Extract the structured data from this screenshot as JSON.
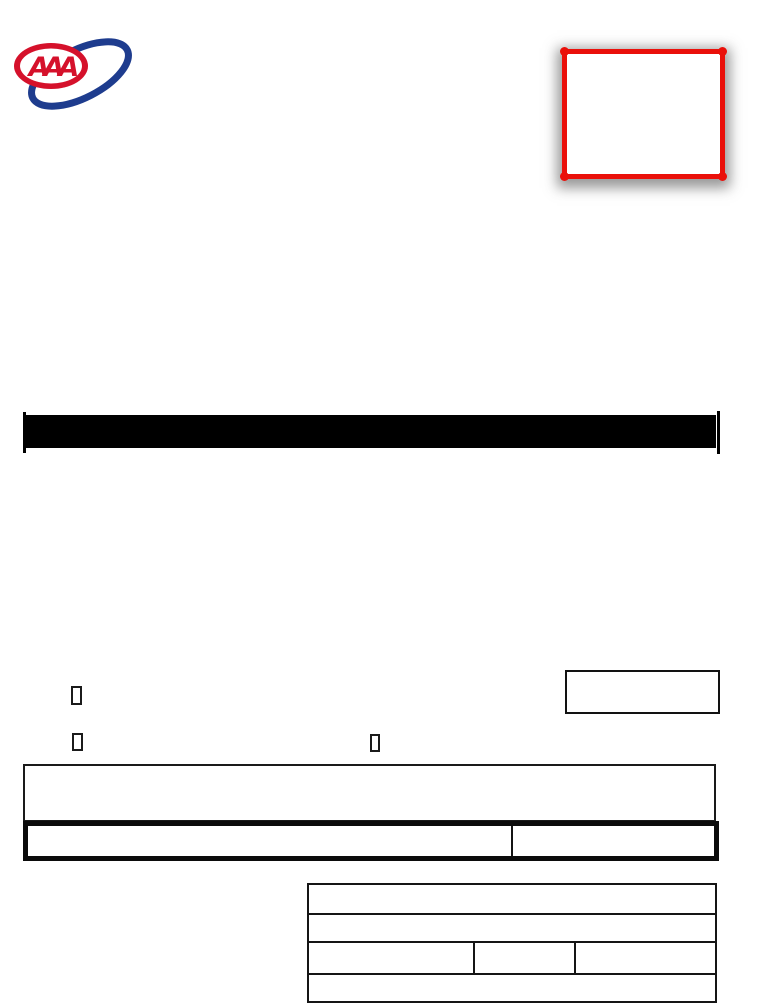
{
  "logo": {
    "label": "AAA",
    "oval_color": "#d5112b",
    "letter_color": "#d5112b",
    "swoosh_color": "#1e3c8e"
  },
  "stamp_box": {
    "border_color": "#ea100a",
    "value": ""
  },
  "divider_bar": {
    "color": "#000000"
  },
  "checkboxes": [
    {
      "name": "checkbox-1",
      "checked": false,
      "label": ""
    },
    {
      "name": "checkbox-2",
      "checked": false,
      "label": ""
    },
    {
      "name": "checkbox-3",
      "checked": false,
      "label": ""
    }
  ],
  "response_box": {
    "value": ""
  },
  "notes_box": {
    "value": ""
  },
  "summary_table": {
    "columns": 2,
    "cells": {
      "left": "",
      "right": ""
    }
  },
  "detail_table": {
    "rows": {
      "row1": {
        "cell1": ""
      },
      "row2": {
        "cell1": ""
      },
      "row3": {
        "cell1": "",
        "cell2": "",
        "cell3": ""
      },
      "row4": {
        "cell1": ""
      }
    }
  }
}
